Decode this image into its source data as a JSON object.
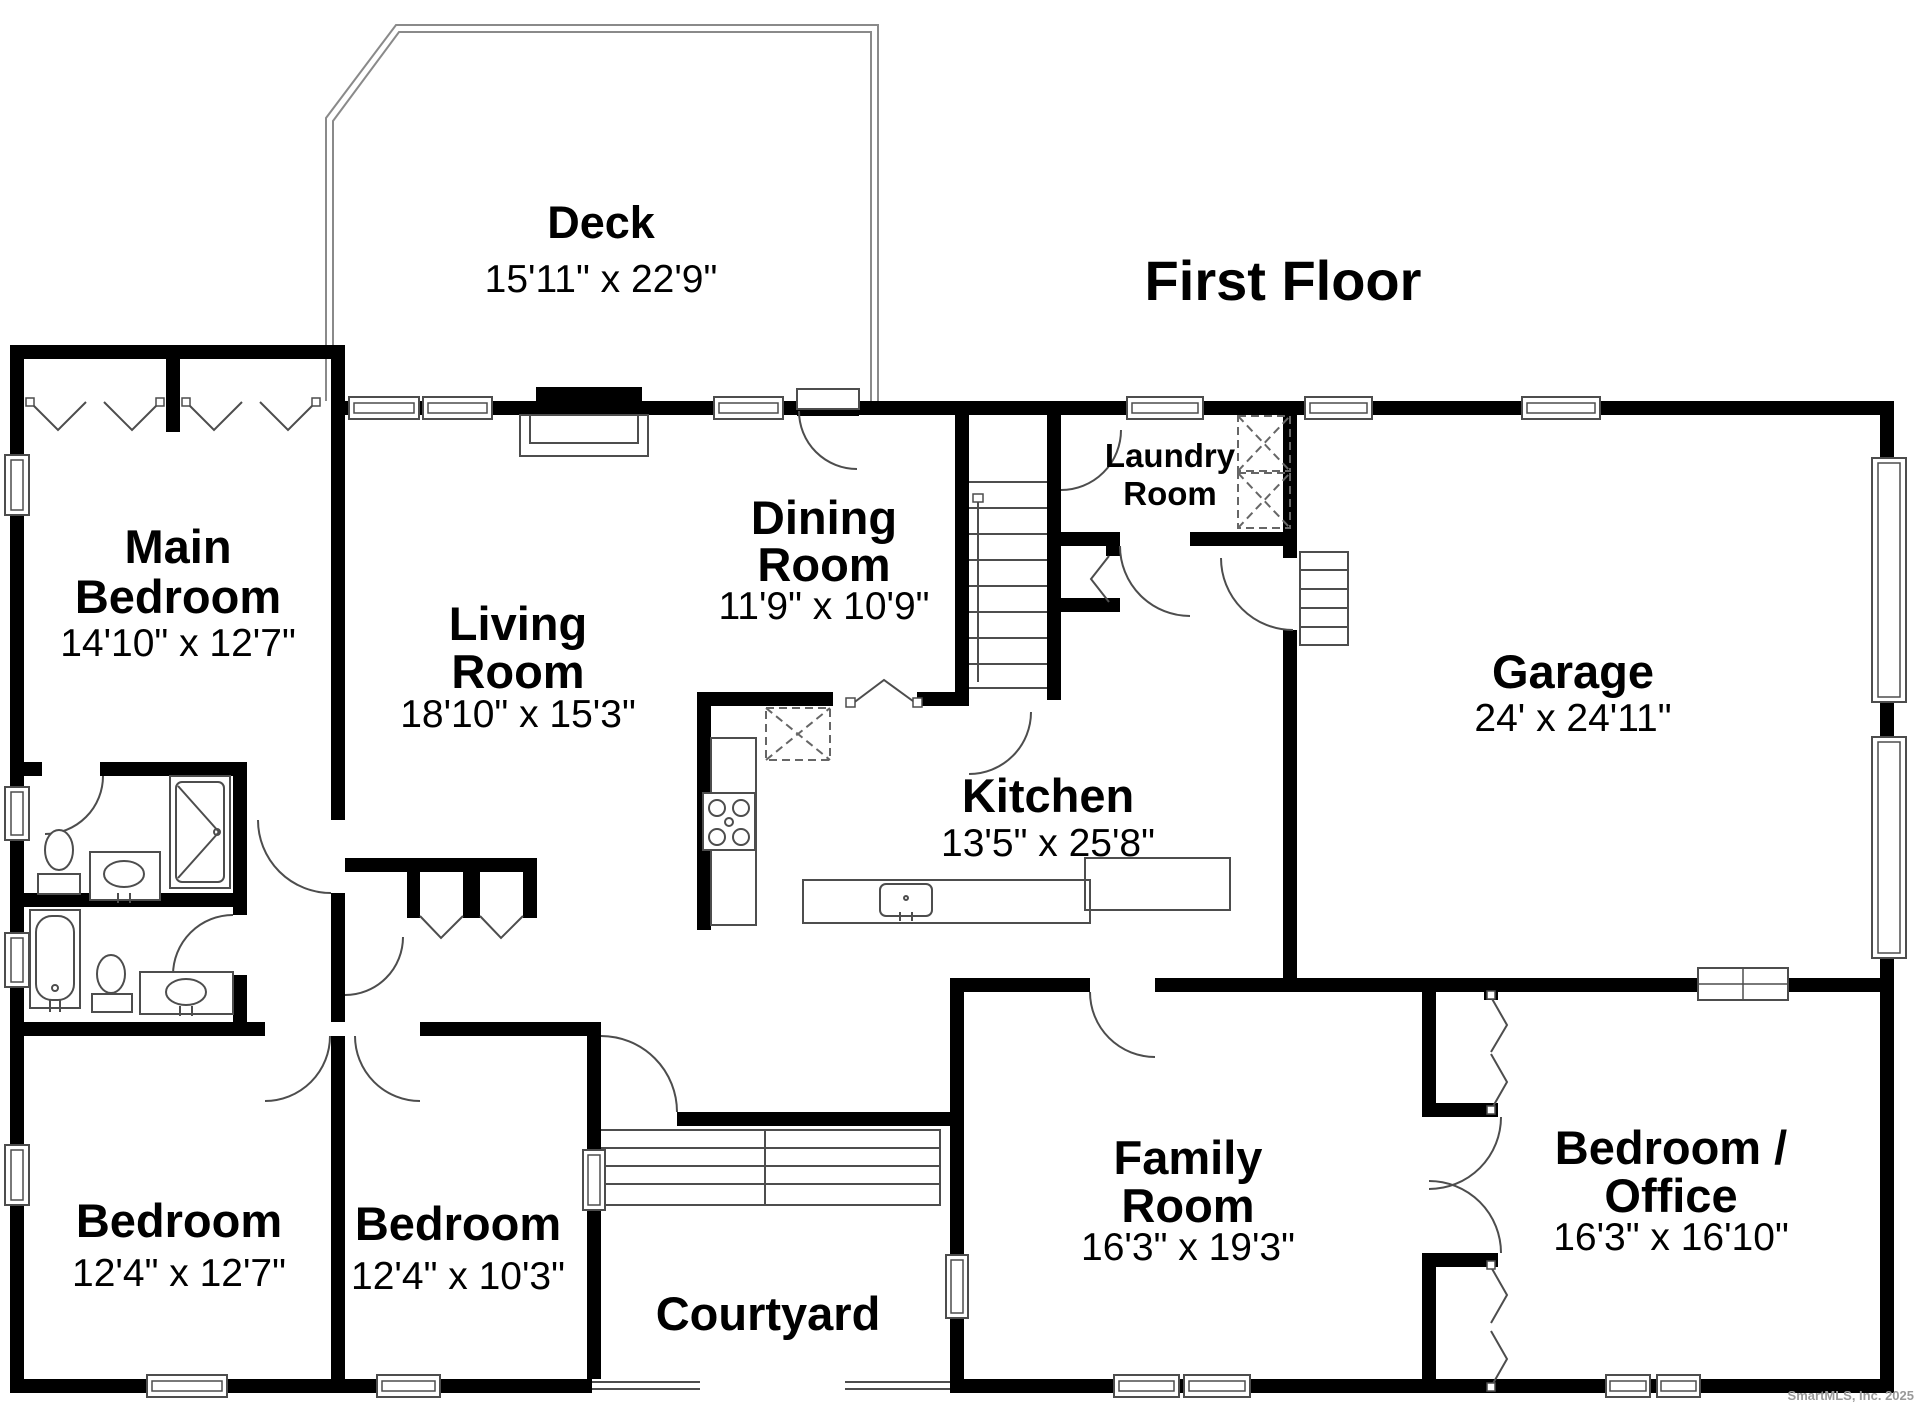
{
  "title": "First Floor",
  "watermark": "SmartMLS, Inc. 2025",
  "colors": {
    "wall": "#000000",
    "thin_line": "#4d4d4d",
    "deck_line": "#8a8a8a",
    "background": "#ffffff",
    "watermark_text": "#999999"
  },
  "rooms": {
    "deck": {
      "name": "Deck",
      "dims": "15'11\" x 22'9\""
    },
    "main_bedroom": {
      "line1": "Main",
      "line2": "Bedroom",
      "dims": "14'10\" x 12'7\""
    },
    "living_room": {
      "line1": "Living",
      "line2": "Room",
      "dims": "18'10\" x 15'3\""
    },
    "dining_room": {
      "line1": "Dining",
      "line2": "Room",
      "dims": "11'9\" x 10'9\""
    },
    "kitchen": {
      "name": "Kitchen",
      "dims": "13'5\" x 25'8\""
    },
    "laundry_room": {
      "line1": "Laundry",
      "line2": "Room"
    },
    "garage": {
      "name": "Garage",
      "dims": "24' x 24'11\""
    },
    "bedroom_left": {
      "name": "Bedroom",
      "dims": "12'4\" x 12'7\""
    },
    "bedroom_middle": {
      "name": "Bedroom",
      "dims": "12'4\" x 10'3\""
    },
    "courtyard": {
      "name": "Courtyard"
    },
    "family_room": {
      "line1": "Family",
      "line2": "Room",
      "dims": "16'3\" x 19'3\""
    },
    "bedroom_office": {
      "line1": "Bedroom /",
      "line2": "Office",
      "dims": "16'3\" x 16'10\""
    }
  }
}
